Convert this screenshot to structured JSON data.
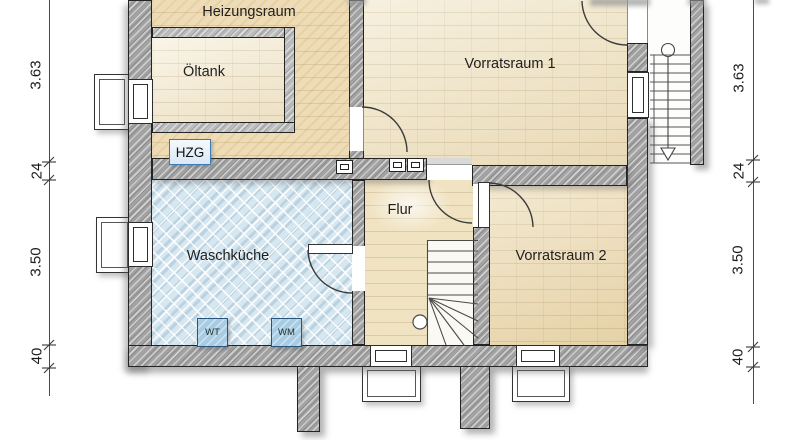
{
  "plan": {
    "rooms": {
      "heizungsraum": {
        "label": "Heizungsraum"
      },
      "oeltank": {
        "label": "Öltank"
      },
      "vorratsraum1": {
        "label": "Vorratsraum 1"
      },
      "waschkueche": {
        "label": "Waschküche"
      },
      "flur": {
        "label": "Flur"
      },
      "vorratsraum2": {
        "label": "Vorratsraum 2"
      }
    },
    "equipment": {
      "hzg": "HZG",
      "wt": "WT",
      "wm": "WM"
    },
    "dimensions": {
      "left": [
        {
          "value": "3.63"
        },
        {
          "value": "24"
        },
        {
          "value": "3.50"
        },
        {
          "value": "40"
        }
      ],
      "right": [
        {
          "value": "3.63"
        },
        {
          "value": "24"
        },
        {
          "value": "3.50"
        },
        {
          "value": "40"
        }
      ]
    },
    "colors": {
      "wall_gray": "#a2a2a2",
      "floor_beige": "#eedcb6",
      "floor_blue": "#d6e7f0",
      "accent_blue": "#3d7ab8"
    }
  }
}
